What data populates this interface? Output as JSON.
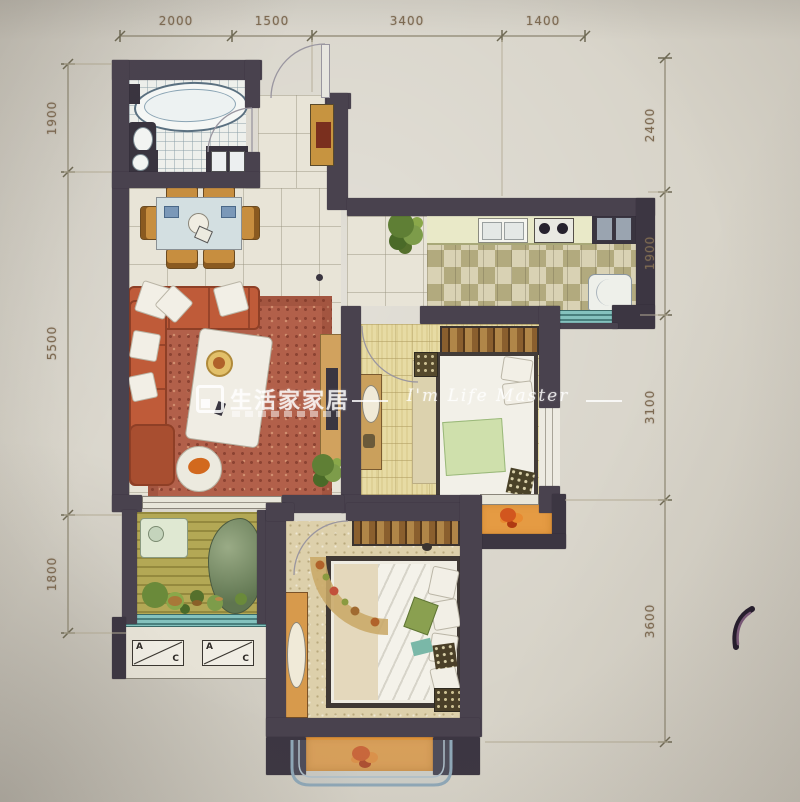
{
  "watermark": {
    "brand": "生活家家居",
    "script": "I'm Life Master"
  },
  "dimensions": {
    "top": [
      "2000",
      "1500",
      "3400",
      "1400"
    ],
    "left": [
      "1900",
      "5500",
      "1800"
    ],
    "right": [
      "2400",
      "1900",
      "3100",
      "3600"
    ]
  },
  "ac_units": {
    "label_a": "A",
    "label_c": "C"
  },
  "colors": {
    "wall": "#49424e",
    "paper": "#d7d3c8",
    "balcony_orange": "#e59b43",
    "sofa_terracotta": "#bf5b39",
    "sill_teal": "#84c2be",
    "dimension_text": "#7d6a52",
    "watermark_white": "#ffffff"
  }
}
